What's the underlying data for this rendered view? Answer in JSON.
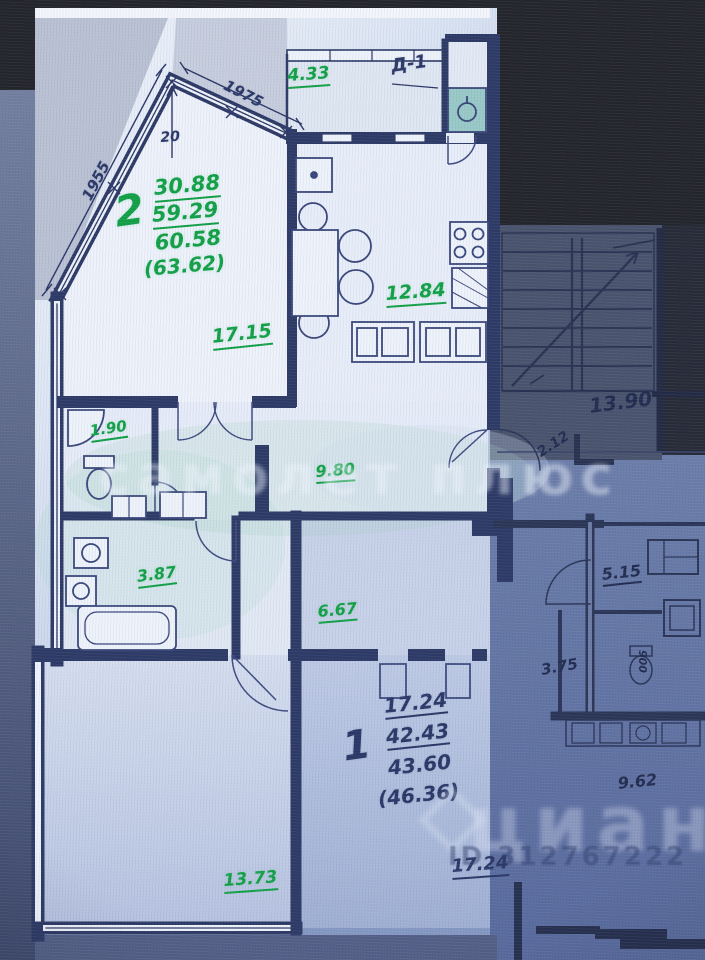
{
  "plan_type": "apartment-floor-plan-photo",
  "apartment2": {
    "unit": "2",
    "areas": {
      "living_total": "30.88",
      "rooms_total": "59.29",
      "total": "60.58",
      "total_with_balcony": "(63.62)"
    },
    "rooms": {
      "living": "17.15",
      "kitchen": "12.84",
      "balcony": "4.33",
      "wc": "1.90",
      "corridor": "9.80",
      "bathroom": "3.87",
      "bedroom": "13.73"
    },
    "dimensions": {
      "bay_left": "1955",
      "bay_apex": "20",
      "bay_right": "1975"
    },
    "door_mark": "Д-1"
  },
  "apartment1": {
    "unit": "1",
    "areas": {
      "living_total": "17.24",
      "rooms_total": "42.43",
      "total": "43.60",
      "total_with_balcony": "(46.36)"
    },
    "rooms": {
      "hall": "6.67",
      "living": "17.24",
      "corridor": "5.15",
      "wc": "3.75",
      "kitchen": "9.62",
      "closet": "2.12"
    },
    "dimensions": {
      "wall": "900"
    }
  },
  "stairwell": {
    "area": "13.90"
  },
  "watermarks": {
    "samolet": "самолет плюс",
    "cian": "циан",
    "listing_id": "ID 312767222"
  },
  "icons": {
    "stairs-icon": "stepped lines with direction arrow",
    "stove-icon": "2x2 burner grid",
    "kitchen-sink-icon": "teal square with circle",
    "dining-table-icon": "table with chairs",
    "fridge-icon": "square with dot",
    "toilet-icon": "ellipse with tank",
    "bathtub-icon": "rounded rectangle",
    "washing-machine-icon": "square in square",
    "cian-house-icon": "rotated square roof"
  },
  "colors": {
    "area_green": "#12a047",
    "ink_blue": "#2b3766",
    "paper_light": "#e9effa",
    "paper_shadow": "#8496c0",
    "photo_dark": "#23252b",
    "stair_zone": "#49536d"
  }
}
